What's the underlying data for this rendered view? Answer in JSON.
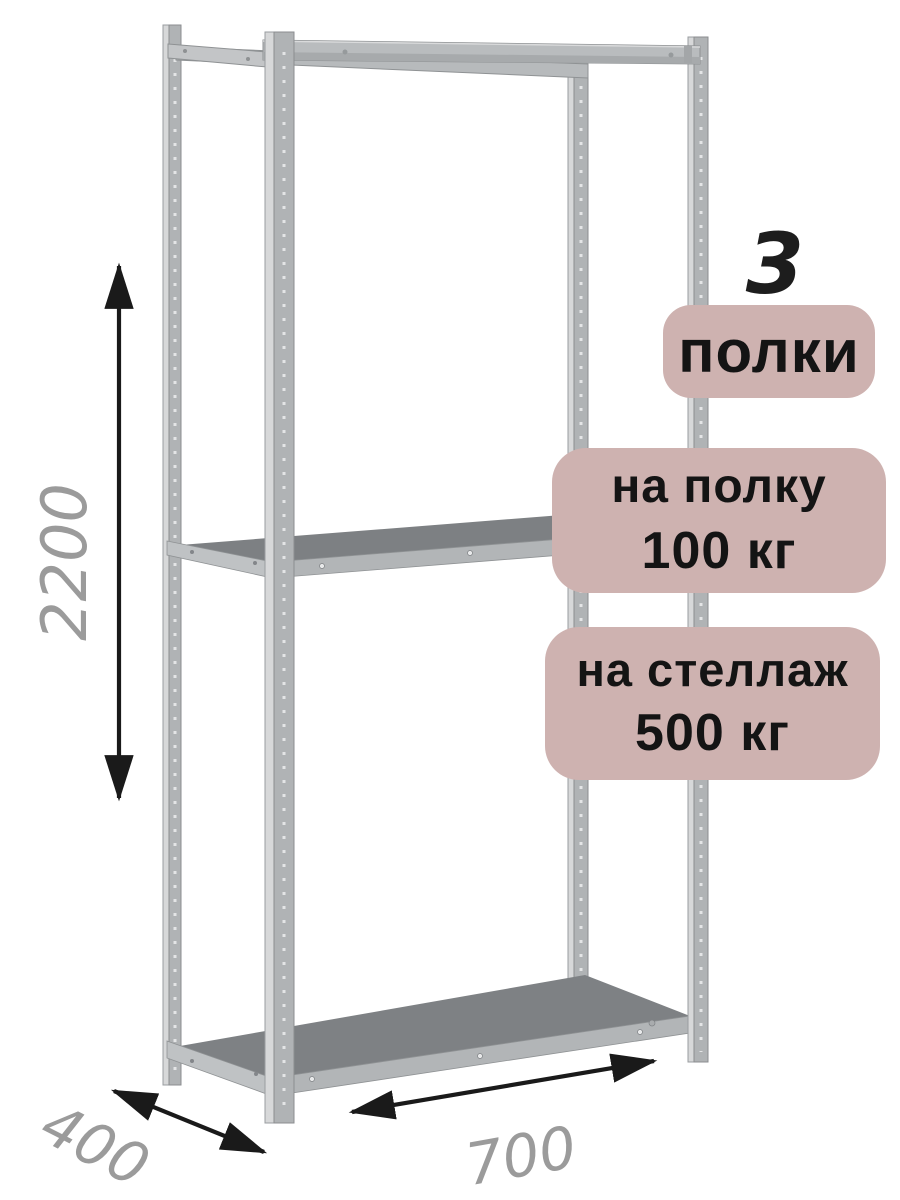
{
  "dimensions": {
    "height": "2200",
    "depth": "400",
    "width": "700"
  },
  "badges": {
    "count": "3",
    "count_label": "полки",
    "shelf_load_line1": "на полку",
    "shelf_load_line2": "100 кг",
    "rack_load_line1": "на стеллаж",
    "rack_load_line2": "500 кг"
  },
  "colors": {
    "badge_bg": "#ceb2b0",
    "badge_text": "#141414",
    "dimension_text": "#9b9b9b",
    "arrow": "#1a1a1a"
  }
}
